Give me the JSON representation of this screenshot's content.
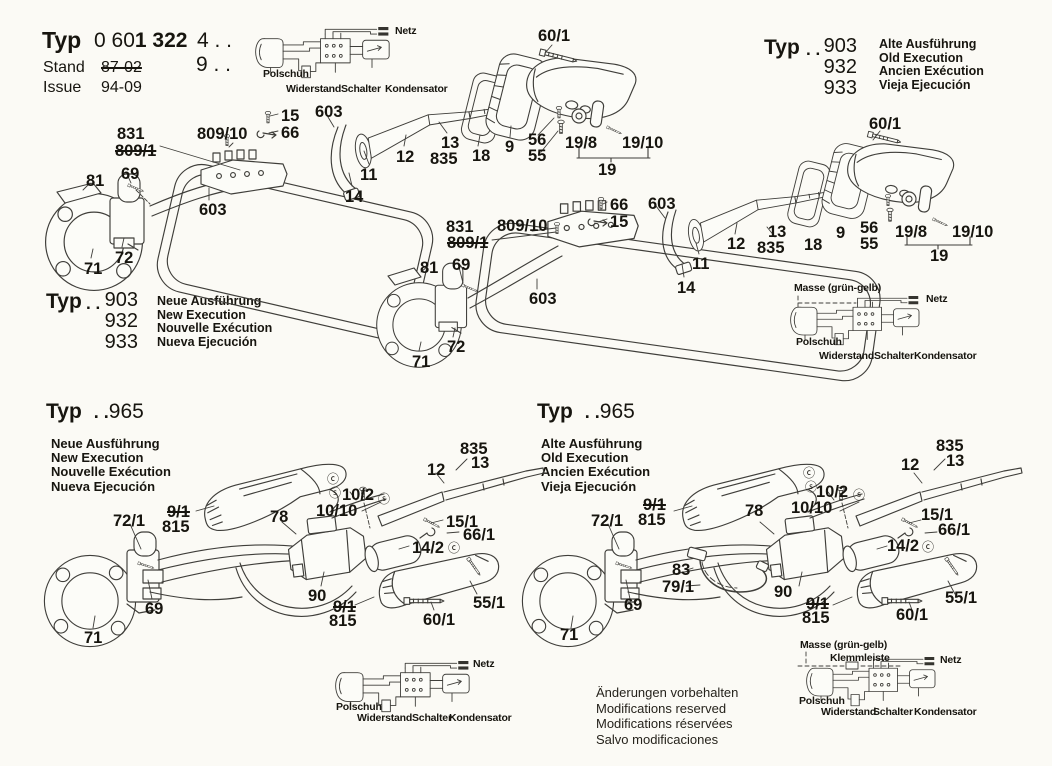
{
  "header": {
    "typ_label": "Typ",
    "model_light": "0 60",
    "model_bold": "1 322",
    "variant1": "4 . .",
    "variant2": "9 . .",
    "stand_label": "Stand",
    "stand_value": "87-02",
    "issue_label": "Issue",
    "issue_value": "94-09"
  },
  "typ_blocks": {
    "top_right": {
      "typ": "Typ",
      "dots": ". .",
      "nums": [
        "903",
        "932",
        "933"
      ],
      "langs": [
        "Alte Ausführung",
        "Old Execution",
        "Ancien Exécution",
        "Vieja Ejecución"
      ]
    },
    "mid_left": {
      "typ": "Typ",
      "dots": ". .",
      "nums": [
        "903",
        "932",
        "933"
      ],
      "langs": [
        "Neue Ausführung",
        "New Execution",
        "Nouvelle Exécution",
        "Nueva Ejecución"
      ]
    },
    "bottom_left": {
      "typ": "Typ",
      "dots": ". .",
      "num": "965",
      "langs": [
        "Neue Ausführung",
        "New Execution",
        "Nouvelle Exécution",
        "Nueva Ejecución"
      ]
    },
    "bottom_right": {
      "typ": "Typ",
      "dots": ". .",
      "num": "965",
      "langs": [
        "Alte Ausführung",
        "Old Execution",
        "Ancien Exécution",
        "Vieja Ejecución"
      ]
    }
  },
  "footer_lines": [
    "Änderungen vorbehalten",
    "Modifications reserved",
    "Modifications réservées",
    "Salvo modificaciones"
  ],
  "labels": {
    "machine_a": [
      {
        "t": "831",
        "x": 117,
        "y": 126
      },
      {
        "t": "809/1",
        "x": 115,
        "y": 143,
        "struck": true
      },
      {
        "t": "809/10",
        "x": 197,
        "y": 126
      },
      {
        "t": "15",
        "x": 281,
        "y": 108
      },
      {
        "t": "66",
        "x": 281,
        "y": 125
      },
      {
        "t": "603",
        "x": 315,
        "y": 104
      },
      {
        "t": "60/1",
        "x": 538,
        "y": 28
      },
      {
        "t": "12",
        "x": 396,
        "y": 149
      },
      {
        "t": "13",
        "x": 441,
        "y": 135
      },
      {
        "t": "835",
        "x": 430,
        "y": 151
      },
      {
        "t": "18",
        "x": 472,
        "y": 148
      },
      {
        "t": "9",
        "x": 505,
        "y": 139
      },
      {
        "t": "56",
        "x": 528,
        "y": 132
      },
      {
        "t": "55",
        "x": 528,
        "y": 148
      },
      {
        "t": "19/8",
        "x": 565,
        "y": 135
      },
      {
        "t": "19/10",
        "x": 622,
        "y": 135
      },
      {
        "t": "19",
        "x": 598,
        "y": 162
      },
      {
        "t": "11",
        "x": 360,
        "y": 167
      },
      {
        "t": "14",
        "x": 345,
        "y": 189
      },
      {
        "t": "81",
        "x": 86,
        "y": 173
      },
      {
        "t": "69",
        "x": 121,
        "y": 166
      },
      {
        "t": "603",
        "x": 199,
        "y": 202
      },
      {
        "t": "72",
        "x": 115,
        "y": 250
      },
      {
        "t": "71",
        "x": 84,
        "y": 261
      }
    ],
    "machine_b": [
      {
        "t": "66",
        "x": 610,
        "y": 197
      },
      {
        "t": "15",
        "x": 610,
        "y": 214
      },
      {
        "t": "603",
        "x": 648,
        "y": 196
      },
      {
        "t": "831",
        "x": 446,
        "y": 219
      },
      {
        "t": "809/10",
        "x": 497,
        "y": 218
      },
      {
        "t": "809/1",
        "x": 447,
        "y": 235,
        "struck": true
      },
      {
        "t": "12",
        "x": 727,
        "y": 236
      },
      {
        "t": "13",
        "x": 768,
        "y": 224
      },
      {
        "t": "835",
        "x": 757,
        "y": 240
      },
      {
        "t": "11",
        "x": 692,
        "y": 256
      },
      {
        "t": "14",
        "x": 677,
        "y": 280
      },
      {
        "t": "81",
        "x": 420,
        "y": 260
      },
      {
        "t": "69",
        "x": 452,
        "y": 257
      },
      {
        "t": "603",
        "x": 529,
        "y": 291
      },
      {
        "t": "72",
        "x": 447,
        "y": 339
      },
      {
        "t": "71",
        "x": 412,
        "y": 354
      },
      {
        "t": "60/1",
        "x": 869,
        "y": 116
      },
      {
        "t": "18",
        "x": 804,
        "y": 237
      },
      {
        "t": "9",
        "x": 836,
        "y": 225
      },
      {
        "t": "56",
        "x": 860,
        "y": 220
      },
      {
        "t": "55",
        "x": 860,
        "y": 236
      },
      {
        "t": "19/8",
        "x": 895,
        "y": 224
      },
      {
        "t": "19/10",
        "x": 952,
        "y": 224
      },
      {
        "t": "19",
        "x": 930,
        "y": 248
      }
    ],
    "machine_c": [
      {
        "t": "835",
        "x": 460,
        "y": 441
      },
      {
        "t": "13",
        "x": 471,
        "y": 455
      },
      {
        "t": "12",
        "x": 427,
        "y": 462
      },
      {
        "t": "9/1",
        "x": 167,
        "y": 504,
        "struck": true
      },
      {
        "t": "815",
        "x": 162,
        "y": 519
      },
      {
        "t": "72/1",
        "x": 113,
        "y": 513
      },
      {
        "t": "78",
        "x": 270,
        "y": 509
      },
      {
        "t": "ⓒ",
        "x": 327,
        "y": 473,
        "circ": true
      },
      {
        "t": "ⓢ",
        "x": 329,
        "y": 487,
        "circ": true
      },
      {
        "t": "10/2",
        "x": 342,
        "y": 487
      },
      {
        "t": "ⓢ",
        "x": 378,
        "y": 493,
        "circ": true
      },
      {
        "t": "10/10",
        "x": 316,
        "y": 503
      },
      {
        "t": "15/1",
        "x": 446,
        "y": 514
      },
      {
        "t": "66/1",
        "x": 463,
        "y": 527
      },
      {
        "t": "14/2",
        "x": 412,
        "y": 540
      },
      {
        "t": "ⓒ",
        "x": 448,
        "y": 542,
        "circ": true
      },
      {
        "t": "90",
        "x": 308,
        "y": 588
      },
      {
        "t": "9/1",
        "x": 333,
        "y": 599,
        "struck": true
      },
      {
        "t": "815",
        "x": 329,
        "y": 613
      },
      {
        "t": "60/1",
        "x": 423,
        "y": 612
      },
      {
        "t": "55/1",
        "x": 473,
        "y": 595
      },
      {
        "t": "69",
        "x": 145,
        "y": 601
      },
      {
        "t": "71",
        "x": 84,
        "y": 630
      }
    ],
    "machine_d": [
      {
        "t": "835",
        "x": 936,
        "y": 438
      },
      {
        "t": "13",
        "x": 946,
        "y": 453
      },
      {
        "t": "12",
        "x": 901,
        "y": 457
      },
      {
        "t": "9/1",
        "x": 643,
        "y": 497,
        "struck": true
      },
      {
        "t": "815",
        "x": 638,
        "y": 512
      },
      {
        "t": "72/1",
        "x": 591,
        "y": 513
      },
      {
        "t": "78",
        "x": 745,
        "y": 503
      },
      {
        "t": "ⓒ",
        "x": 803,
        "y": 467,
        "circ": true
      },
      {
        "t": "ⓢ",
        "x": 805,
        "y": 481,
        "circ": true
      },
      {
        "t": "10/2",
        "x": 816,
        "y": 484
      },
      {
        "t": "ⓢ",
        "x": 853,
        "y": 489,
        "circ": true
      },
      {
        "t": "10/10",
        "x": 791,
        "y": 500
      },
      {
        "t": "15/1",
        "x": 921,
        "y": 507
      },
      {
        "t": "66/1",
        "x": 938,
        "y": 522
      },
      {
        "t": "14/2",
        "x": 887,
        "y": 538
      },
      {
        "t": "ⓒ",
        "x": 922,
        "y": 541,
        "circ": true
      },
      {
        "t": "83",
        "x": 672,
        "y": 562
      },
      {
        "t": "79/1",
        "x": 662,
        "y": 579
      },
      {
        "t": "90",
        "x": 774,
        "y": 584
      },
      {
        "t": "9/1",
        "x": 806,
        "y": 596,
        "struck": true
      },
      {
        "t": "815",
        "x": 802,
        "y": 610
      },
      {
        "t": "60/1",
        "x": 896,
        "y": 607
      },
      {
        "t": "55/1",
        "x": 945,
        "y": 590
      },
      {
        "t": "69",
        "x": 624,
        "y": 597
      },
      {
        "t": "71",
        "x": 560,
        "y": 627
      }
    ],
    "wiring_top": [
      {
        "t": "Netz",
        "x": 395,
        "y": 26,
        "small": true
      },
      {
        "t": "Polschuh",
        "x": 263,
        "y": 69,
        "small": true
      },
      {
        "t": "Widerstand",
        "x": 286,
        "y": 84,
        "small": true
      },
      {
        "t": "Schalter",
        "x": 341,
        "y": 84,
        "small": true
      },
      {
        "t": "Kondensator",
        "x": 385,
        "y": 84,
        "small": true
      }
    ],
    "wiring_mid_right": [
      {
        "t": "Masse (grün-gelb)",
        "x": 794,
        "y": 283,
        "small": true
      },
      {
        "t": "Netz",
        "x": 926,
        "y": 294,
        "small": true
      },
      {
        "t": "Polschuh",
        "x": 796,
        "y": 337,
        "small": true
      },
      {
        "t": "Widerstand",
        "x": 819,
        "y": 351,
        "small": true
      },
      {
        "t": "Schalter",
        "x": 874,
        "y": 351,
        "small": true
      },
      {
        "t": "Kondensator",
        "x": 914,
        "y": 351,
        "small": true
      }
    ],
    "wiring_bottom_left": [
      {
        "t": "Netz",
        "x": 473,
        "y": 659,
        "small": true
      },
      {
        "t": "Polschuh",
        "x": 336,
        "y": 702,
        "small": true
      },
      {
        "t": "Widerstand",
        "x": 357,
        "y": 713,
        "small": true
      },
      {
        "t": "Schalter",
        "x": 412,
        "y": 713,
        "small": true
      },
      {
        "t": "Kondensator",
        "x": 449,
        "y": 713,
        "small": true
      }
    ],
    "wiring_bottom_right": [
      {
        "t": "Masse (grün-gelb)",
        "x": 800,
        "y": 640,
        "small": true
      },
      {
        "t": "Klemmleiste",
        "x": 830,
        "y": 653,
        "small": true
      },
      {
        "t": "Netz",
        "x": 940,
        "y": 655,
        "small": true
      },
      {
        "t": "Polschuh",
        "x": 799,
        "y": 696,
        "small": true
      },
      {
        "t": "Widerstand",
        "x": 821,
        "y": 707,
        "small": true
      },
      {
        "t": "Schalter",
        "x": 873,
        "y": 707,
        "small": true
      },
      {
        "t": "Kondensator",
        "x": 914,
        "y": 707,
        "small": true
      }
    ]
  }
}
